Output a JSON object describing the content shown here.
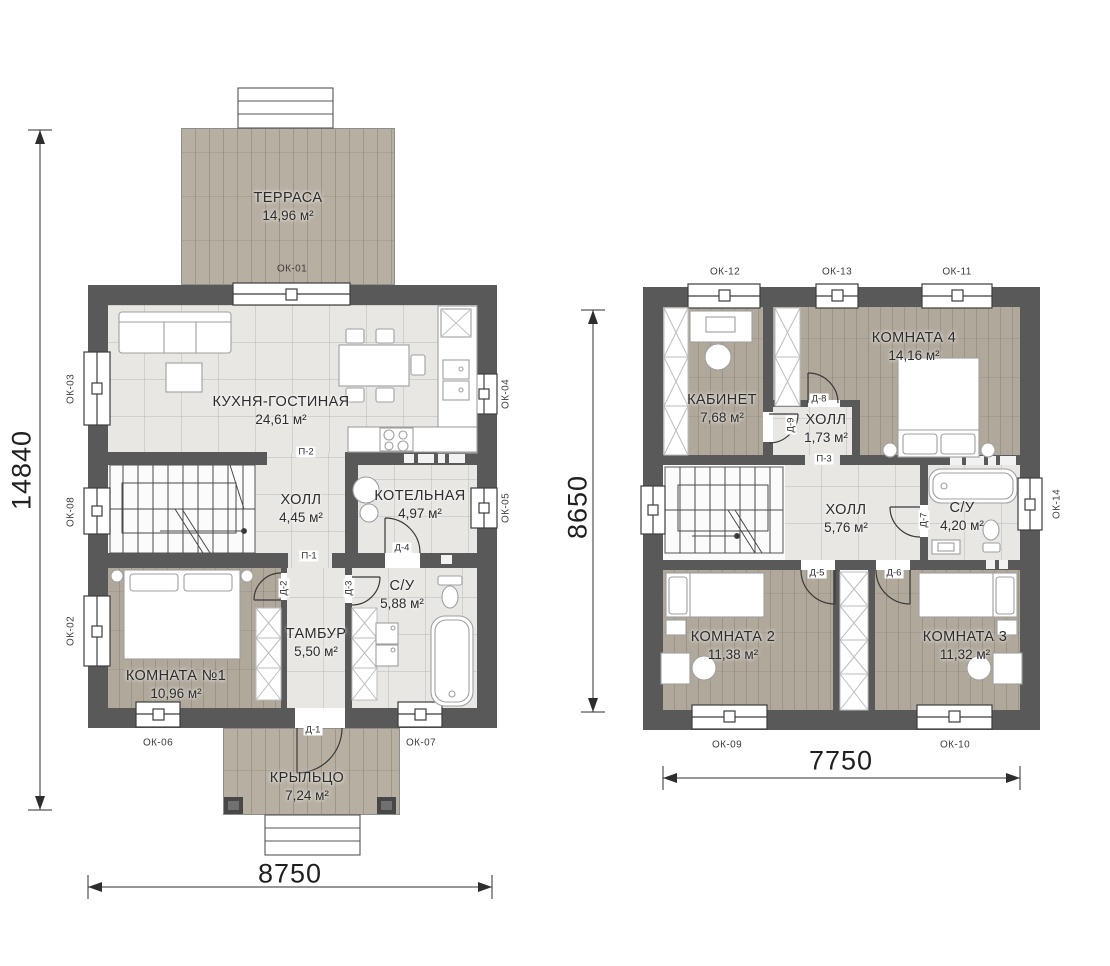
{
  "floor1": {
    "rooms": {
      "terrace": {
        "name": "ТЕРРАСА",
        "area": "14,96 м²"
      },
      "kitchen_living": {
        "name": "КУХНЯ-ГОСТИНАЯ",
        "area": "24,61 м²"
      },
      "hall": {
        "name": "ХОЛЛ",
        "area": "4,45 м²"
      },
      "boiler": {
        "name": "КОТЕЛЬНАЯ",
        "area": "4,97 м²"
      },
      "bathroom": {
        "name": "С/У",
        "area": "5,88 м²"
      },
      "vestibule": {
        "name": "ТАМБУР",
        "area": "5,50 м²"
      },
      "room1": {
        "name": "КОМНАТА №1",
        "area": "10,96 м²"
      },
      "porch": {
        "name": "КРЫЛЬЦО",
        "area": "7,24 м²"
      }
    },
    "windows": {
      "ok01": "ОК-01",
      "ok02": "ОК-02",
      "ok03": "ОК-03",
      "ok04": "ОК-04",
      "ok05": "ОК-05",
      "ok06": "ОК-06",
      "ok07": "ОК-07",
      "ok08": "ОК-08"
    },
    "doors": {
      "d1": "Д-1",
      "d2": "Д-2",
      "d3": "Д-3",
      "d4": "Д-4",
      "p1": "П-1",
      "p2": "П-2"
    },
    "dimensions": {
      "height_mm": "14840",
      "width_mm": "8750"
    }
  },
  "floor2": {
    "rooms": {
      "office": {
        "name": "КАБИНЕТ",
        "area": "7,68 м²"
      },
      "hall_small": {
        "name": "ХОЛЛ",
        "area": "1,73 м²"
      },
      "room4": {
        "name": "КОМНАТА 4",
        "area": "14,16 м²"
      },
      "hall": {
        "name": "ХОЛЛ",
        "area": "5,76 м²"
      },
      "bathroom": {
        "name": "С/У",
        "area": "4,20 м²"
      },
      "room2": {
        "name": "КОМНАТА 2",
        "area": "11,38 м²"
      },
      "room3": {
        "name": "КОМНАТА 3",
        "area": "11,32 м²"
      }
    },
    "windows": {
      "ok09": "ОК-09",
      "ok10": "ОК-10",
      "ok11": "ОК-11",
      "ok12": "ОК-12",
      "ok13": "ОК-13",
      "ok14": "ОК-14"
    },
    "doors": {
      "d5": "Д-5",
      "d6": "Д-6",
      "d7": "Д-7",
      "d8": "Д-8",
      "d9": "Д-9",
      "p3": "П-3"
    },
    "dimensions": {
      "height_mm": "8650",
      "width_mm": "7750"
    }
  },
  "colors": {
    "wall": "#595959",
    "tile": "#e8e7e4",
    "wood": "#b2aa9d",
    "line": "#3c3c3c"
  }
}
